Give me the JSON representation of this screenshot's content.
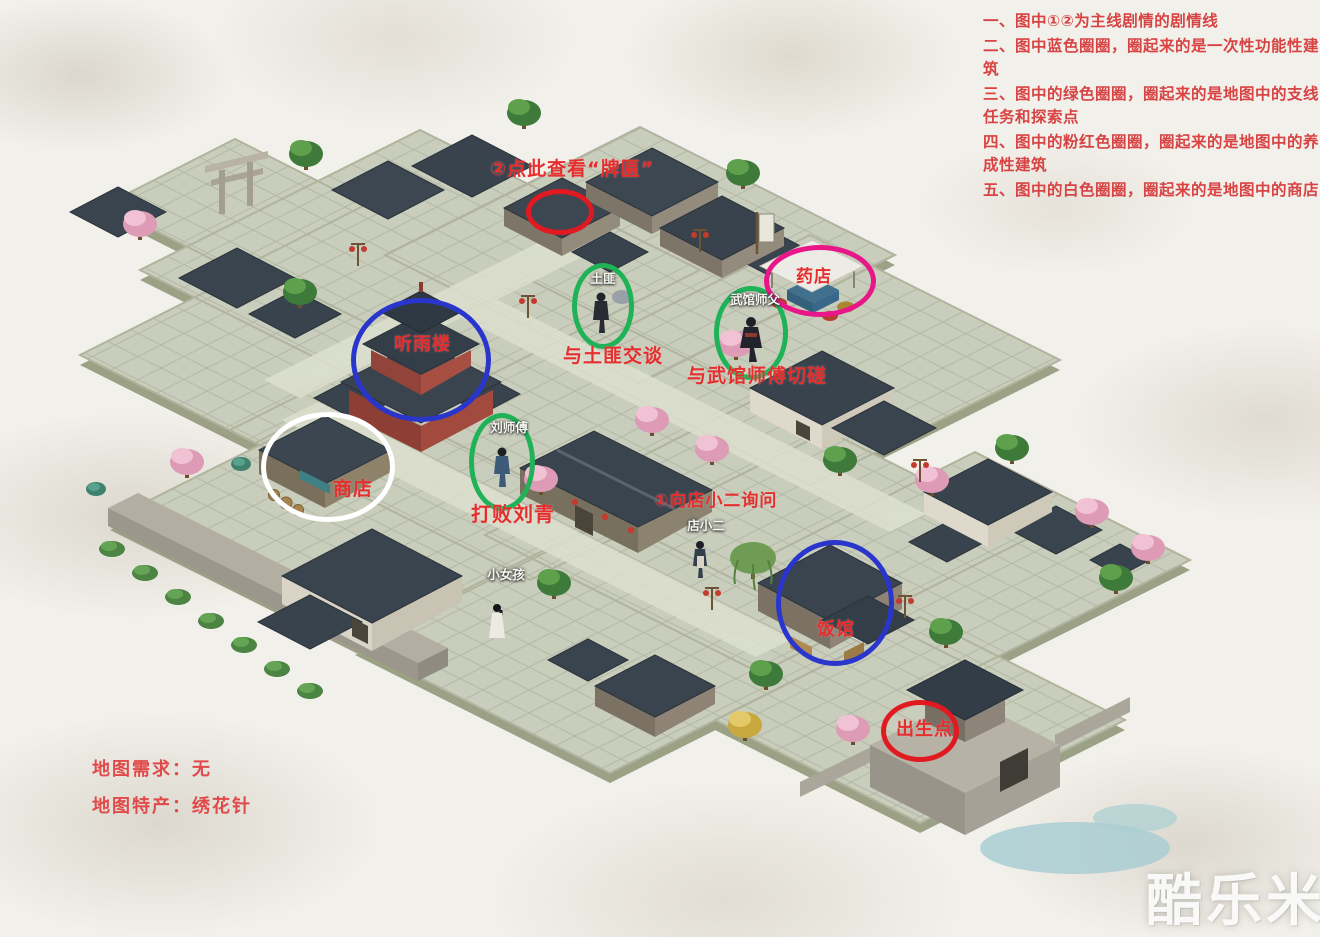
{
  "legend": {
    "items": [
      "一、图中①②为主线剧情的剧情线",
      "二、图中蓝色圈圈，圈起来的是一次性功能性建筑",
      "三、图中的绿色圈圈，圈起来的是地图中的支线任务和探索点",
      "四、图中的粉红色圈圈，圈起来的是地图中的养成性建筑",
      "五、图中的白色圈圈，圈起来的是地图中的商店"
    ]
  },
  "map_info": {
    "lines": [
      "地图需求：无",
      "地图特产：绣花针"
    ]
  },
  "annotations": {
    "colors": {
      "red": "#e11a22",
      "blue": "#2a35cc",
      "green": "#1fb257",
      "pink": "#e81688",
      "white": "#ffffff"
    },
    "circles": [
      {
        "name": "note-house",
        "color": "red",
        "x": 560,
        "y": 212,
        "rx": 34,
        "ry": 23
      },
      {
        "name": "bandit",
        "color": "green",
        "x": 603,
        "y": 306,
        "rx": 31,
        "ry": 43
      },
      {
        "name": "martial-master",
        "color": "green",
        "x": 751,
        "y": 333,
        "rx": 37,
        "ry": 47
      },
      {
        "name": "pharmacy-stall",
        "color": "pink",
        "x": 820,
        "y": 281,
        "rx": 56,
        "ry": 36
      },
      {
        "name": "tower",
        "color": "blue",
        "x": 421,
        "y": 360,
        "rx": 70,
        "ry": 62
      },
      {
        "name": "shop",
        "color": "white",
        "x": 328,
        "y": 467,
        "rx": 67,
        "ry": 55
      },
      {
        "name": "liu-qing",
        "color": "green",
        "x": 502,
        "y": 462,
        "rx": 33,
        "ry": 49
      },
      {
        "name": "restaurant",
        "color": "blue",
        "x": 835,
        "y": 603,
        "rx": 59,
        "ry": 63
      },
      {
        "name": "spawn",
        "color": "red",
        "x": 920,
        "y": 731,
        "rx": 39,
        "ry": 31
      }
    ],
    "labels": [
      {
        "text": "②点此查看“牌匾”",
        "x": 490,
        "y": 160,
        "size": 19
      },
      {
        "text": "与土匪交谈",
        "x": 563,
        "y": 347,
        "size": 19
      },
      {
        "text": "与武馆师傅切磋",
        "x": 687,
        "y": 367,
        "size": 19
      },
      {
        "text": "药店",
        "x": 796,
        "y": 269,
        "size": 17
      },
      {
        "text": "听雨楼",
        "x": 394,
        "y": 336,
        "size": 18
      },
      {
        "text": "商店",
        "x": 333,
        "y": 480,
        "size": 19
      },
      {
        "text": "打败刘青",
        "x": 471,
        "y": 504,
        "size": 20
      },
      {
        "text": "①向店小二询问",
        "x": 654,
        "y": 493,
        "size": 17
      },
      {
        "text": "饭馆",
        "x": 817,
        "y": 621,
        "size": 18
      },
      {
        "text": "出生点",
        "x": 896,
        "y": 721,
        "size": 18
      }
    ],
    "npc_tags": [
      {
        "text": "土匪",
        "x": 603,
        "y": 273
      },
      {
        "text": "武馆师父",
        "x": 755,
        "y": 294
      },
      {
        "text": "刘师傅",
        "x": 509,
        "y": 422
      },
      {
        "text": "店小二",
        "x": 706,
        "y": 520
      },
      {
        "text": "小女孩",
        "x": 506,
        "y": 569
      }
    ]
  },
  "watermark": {
    "text": "酷乐米"
  }
}
